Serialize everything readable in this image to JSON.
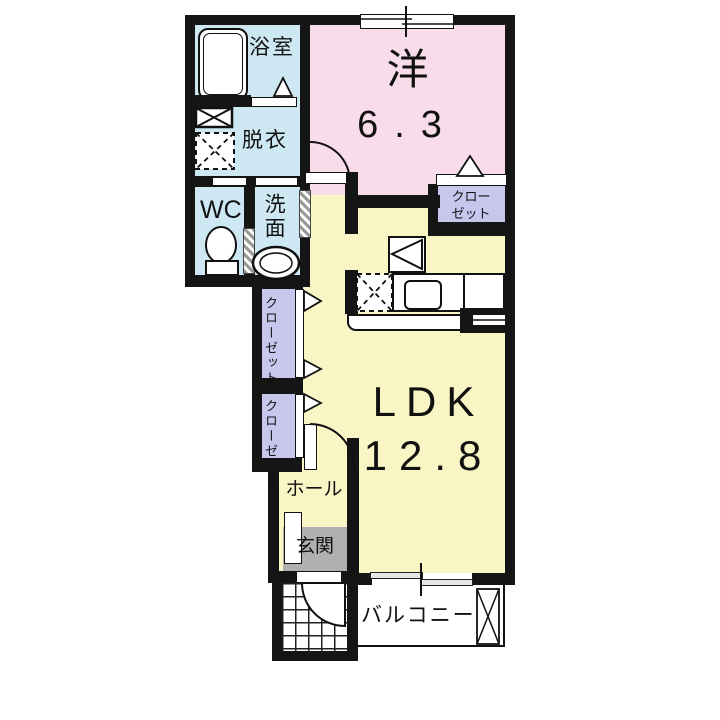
{
  "title": "1LDK apartment floor plan",
  "rooms": {
    "bathroom": {
      "label": "浴室"
    },
    "dressing": {
      "label": "脱衣"
    },
    "wc": {
      "label": "WC"
    },
    "washroom": {
      "label": "洗面"
    },
    "western": {
      "label": "洋",
      "size": "6.3"
    },
    "closet_tr": {
      "label": "クローゼット"
    },
    "closet_a": {
      "label": "クローゼット"
    },
    "closet_b": {
      "label": "クローゼット"
    },
    "ldk": {
      "label": "LDK",
      "size": "12.8"
    },
    "hall": {
      "label": "ホール"
    },
    "entrance": {
      "label": "玄関"
    },
    "balcony": {
      "label": "バルコニー"
    }
  },
  "colors": {
    "wall": "#151515",
    "water_rooms": "#cde8f2",
    "western_room": "#f9dcea",
    "ldk": "#faf5c5",
    "closet": "#c7c7ee",
    "entrance": "#b0b0b0",
    "balcony": "#ffffff"
  }
}
